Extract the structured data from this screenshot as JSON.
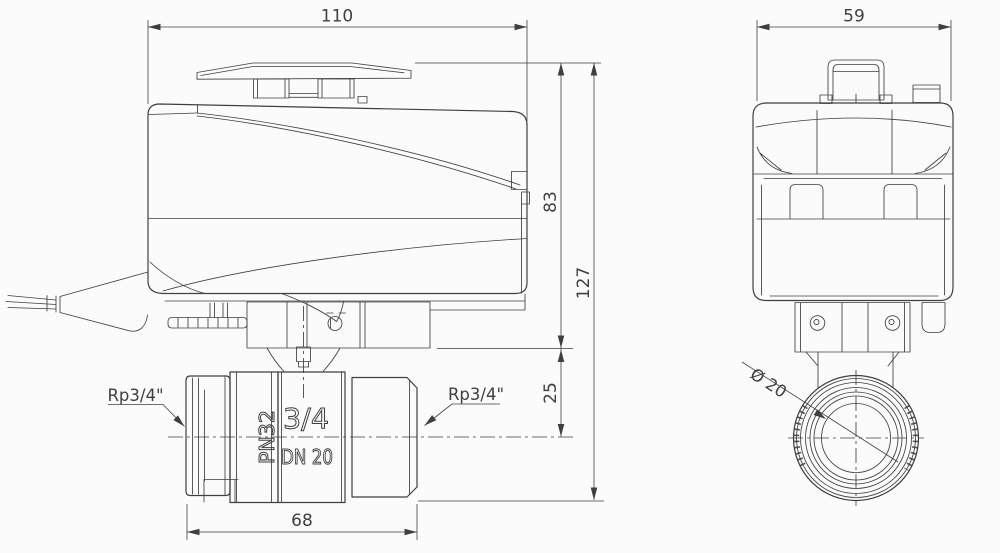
{
  "palette": {
    "line_color": "#3f3f3f",
    "background": "#fbfbfb"
  },
  "front_view": {
    "dims": {
      "width": "110",
      "actuator_height": "83",
      "overall_height": "127",
      "bracket_to_axis": "25",
      "valve_length": "68"
    },
    "labels": {
      "thread_left": "Rp3/4\"",
      "thread_right": "Rp3/4\""
    },
    "markings": {
      "pn": "PN32",
      "size": "3/4",
      "dn": "DN 20"
    }
  },
  "side_view": {
    "dims": {
      "width": "59"
    },
    "labels": {
      "bore": "Ø 20"
    }
  }
}
